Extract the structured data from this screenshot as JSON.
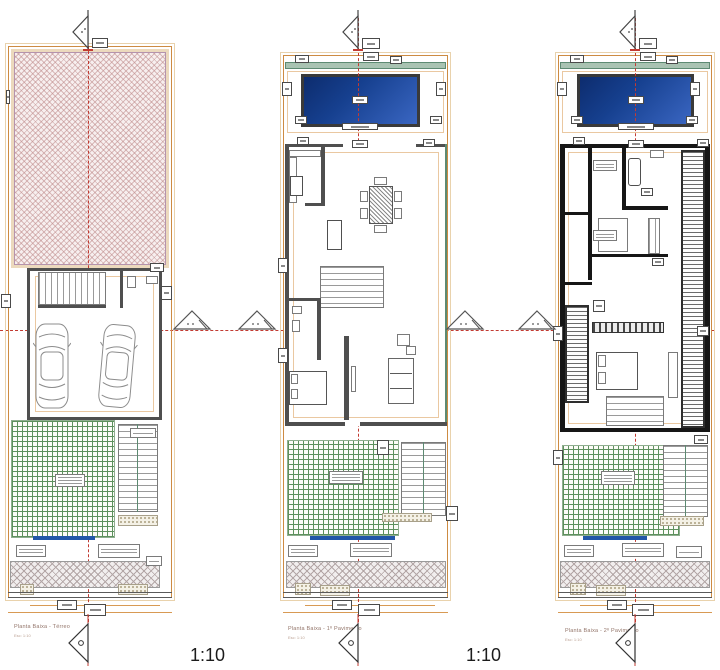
{
  "sheet": {
    "title_block": {
      "scale_left": "1:10",
      "scale_right": "1:10"
    },
    "plans": [
      {
        "id": "terreo",
        "title": "Planta Baixa - Térreo",
        "subtitle": "Esc: 1:10"
      },
      {
        "id": "pavimento-1",
        "title": "Planta Baixa - 1º Pavimento",
        "subtitle": "Esc: 1:10"
      },
      {
        "id": "pavimento-2",
        "title": "Planta Baixa - 2º Pavimento",
        "subtitle": "Esc: 1:10"
      }
    ],
    "colors": {
      "boundary": "#cd8b42",
      "hatch": "#ba8282",
      "wall": "#4f4f4f",
      "pool_dark": "#0d2c6e",
      "pool_light": "#3a66c2",
      "grass": "#5d905d",
      "centerline": "#c23b32",
      "teal": "#5d8a72",
      "blue_strip": "#2257a8"
    }
  }
}
